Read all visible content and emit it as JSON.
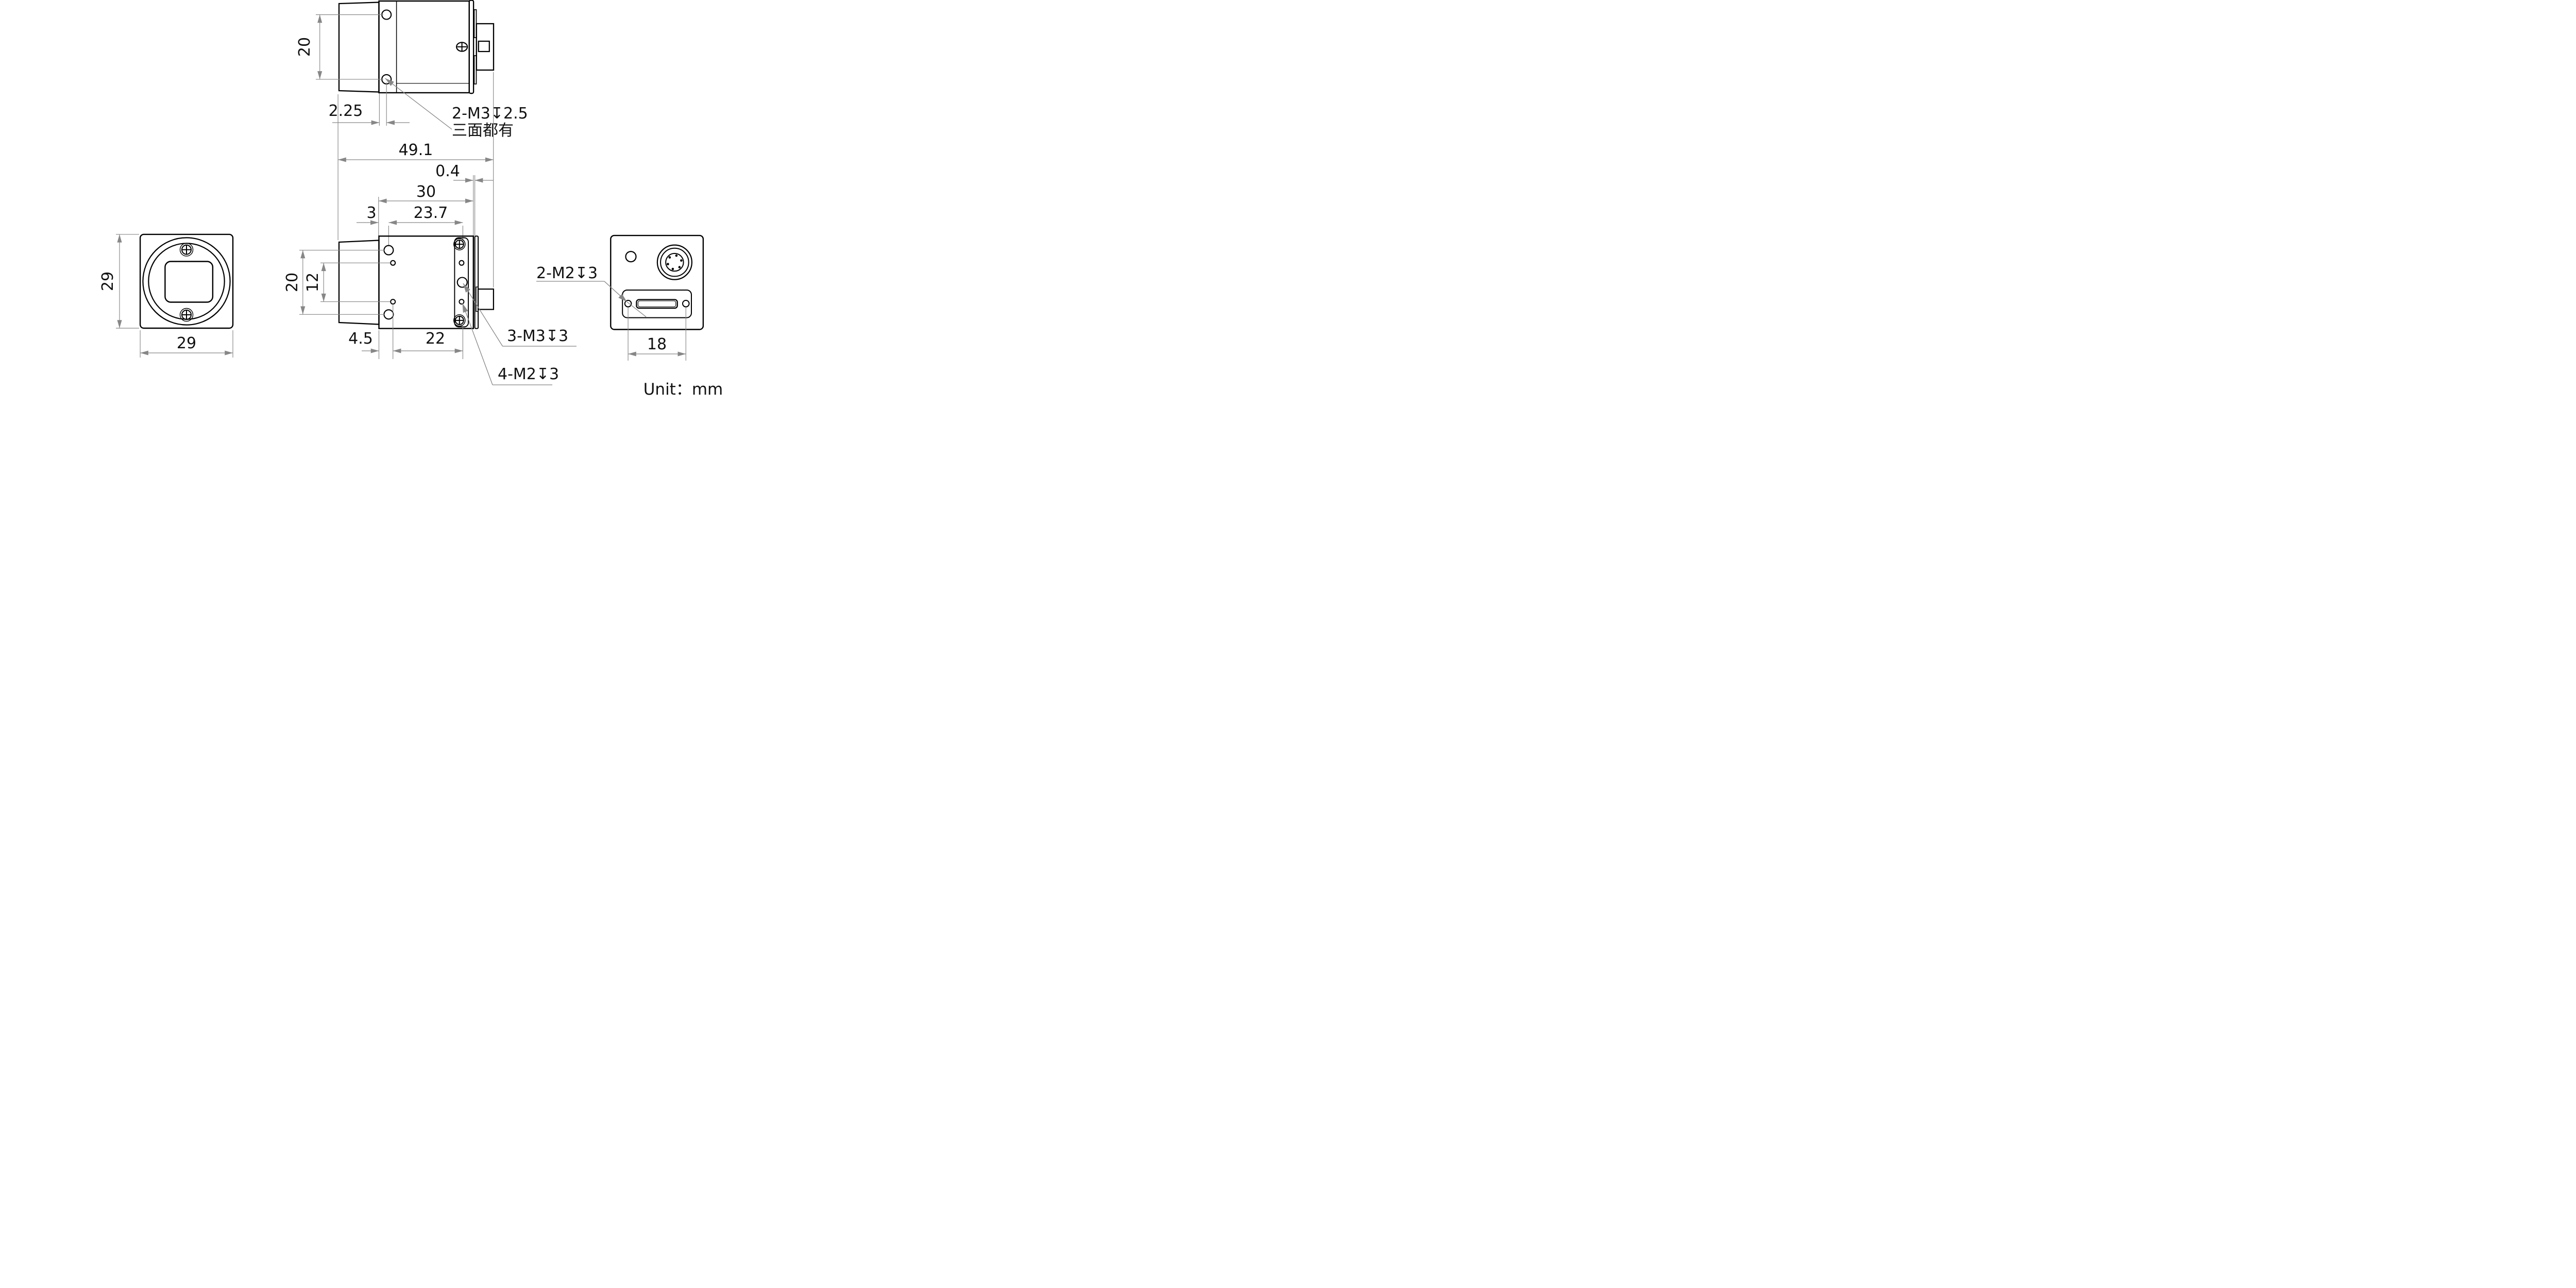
{
  "unit_note": "Unit：mm",
  "colors": {
    "outline": "#000000",
    "dimension": "#878787",
    "background": "#ffffff"
  },
  "views": {
    "top_view": {
      "dim_hole_spacing": "20",
      "dim_hole_offset": "2.25",
      "thread_note_line1": "2-M3↧2.5",
      "thread_note_line2": "三面都有"
    },
    "length_dims": {
      "overall": "49.1",
      "rear_gap": "0.4",
      "body": "30",
      "face_to_hole": "3",
      "hole_span": "23.7"
    },
    "front_view": {
      "dim_height": "29",
      "dim_width": "29"
    },
    "side_view": {
      "dim_hole_spacing": "20",
      "dim_small_hole_spacing": "12",
      "dim_face_to_small_hole": "4.5",
      "dim_small_hole_span": "22",
      "thread_note_m3": "3-M3↧3",
      "thread_note_m2": "4-M2↧3"
    },
    "back_view": {
      "dim_hole_span": "18",
      "thread_note": "2-M2↧3"
    }
  }
}
